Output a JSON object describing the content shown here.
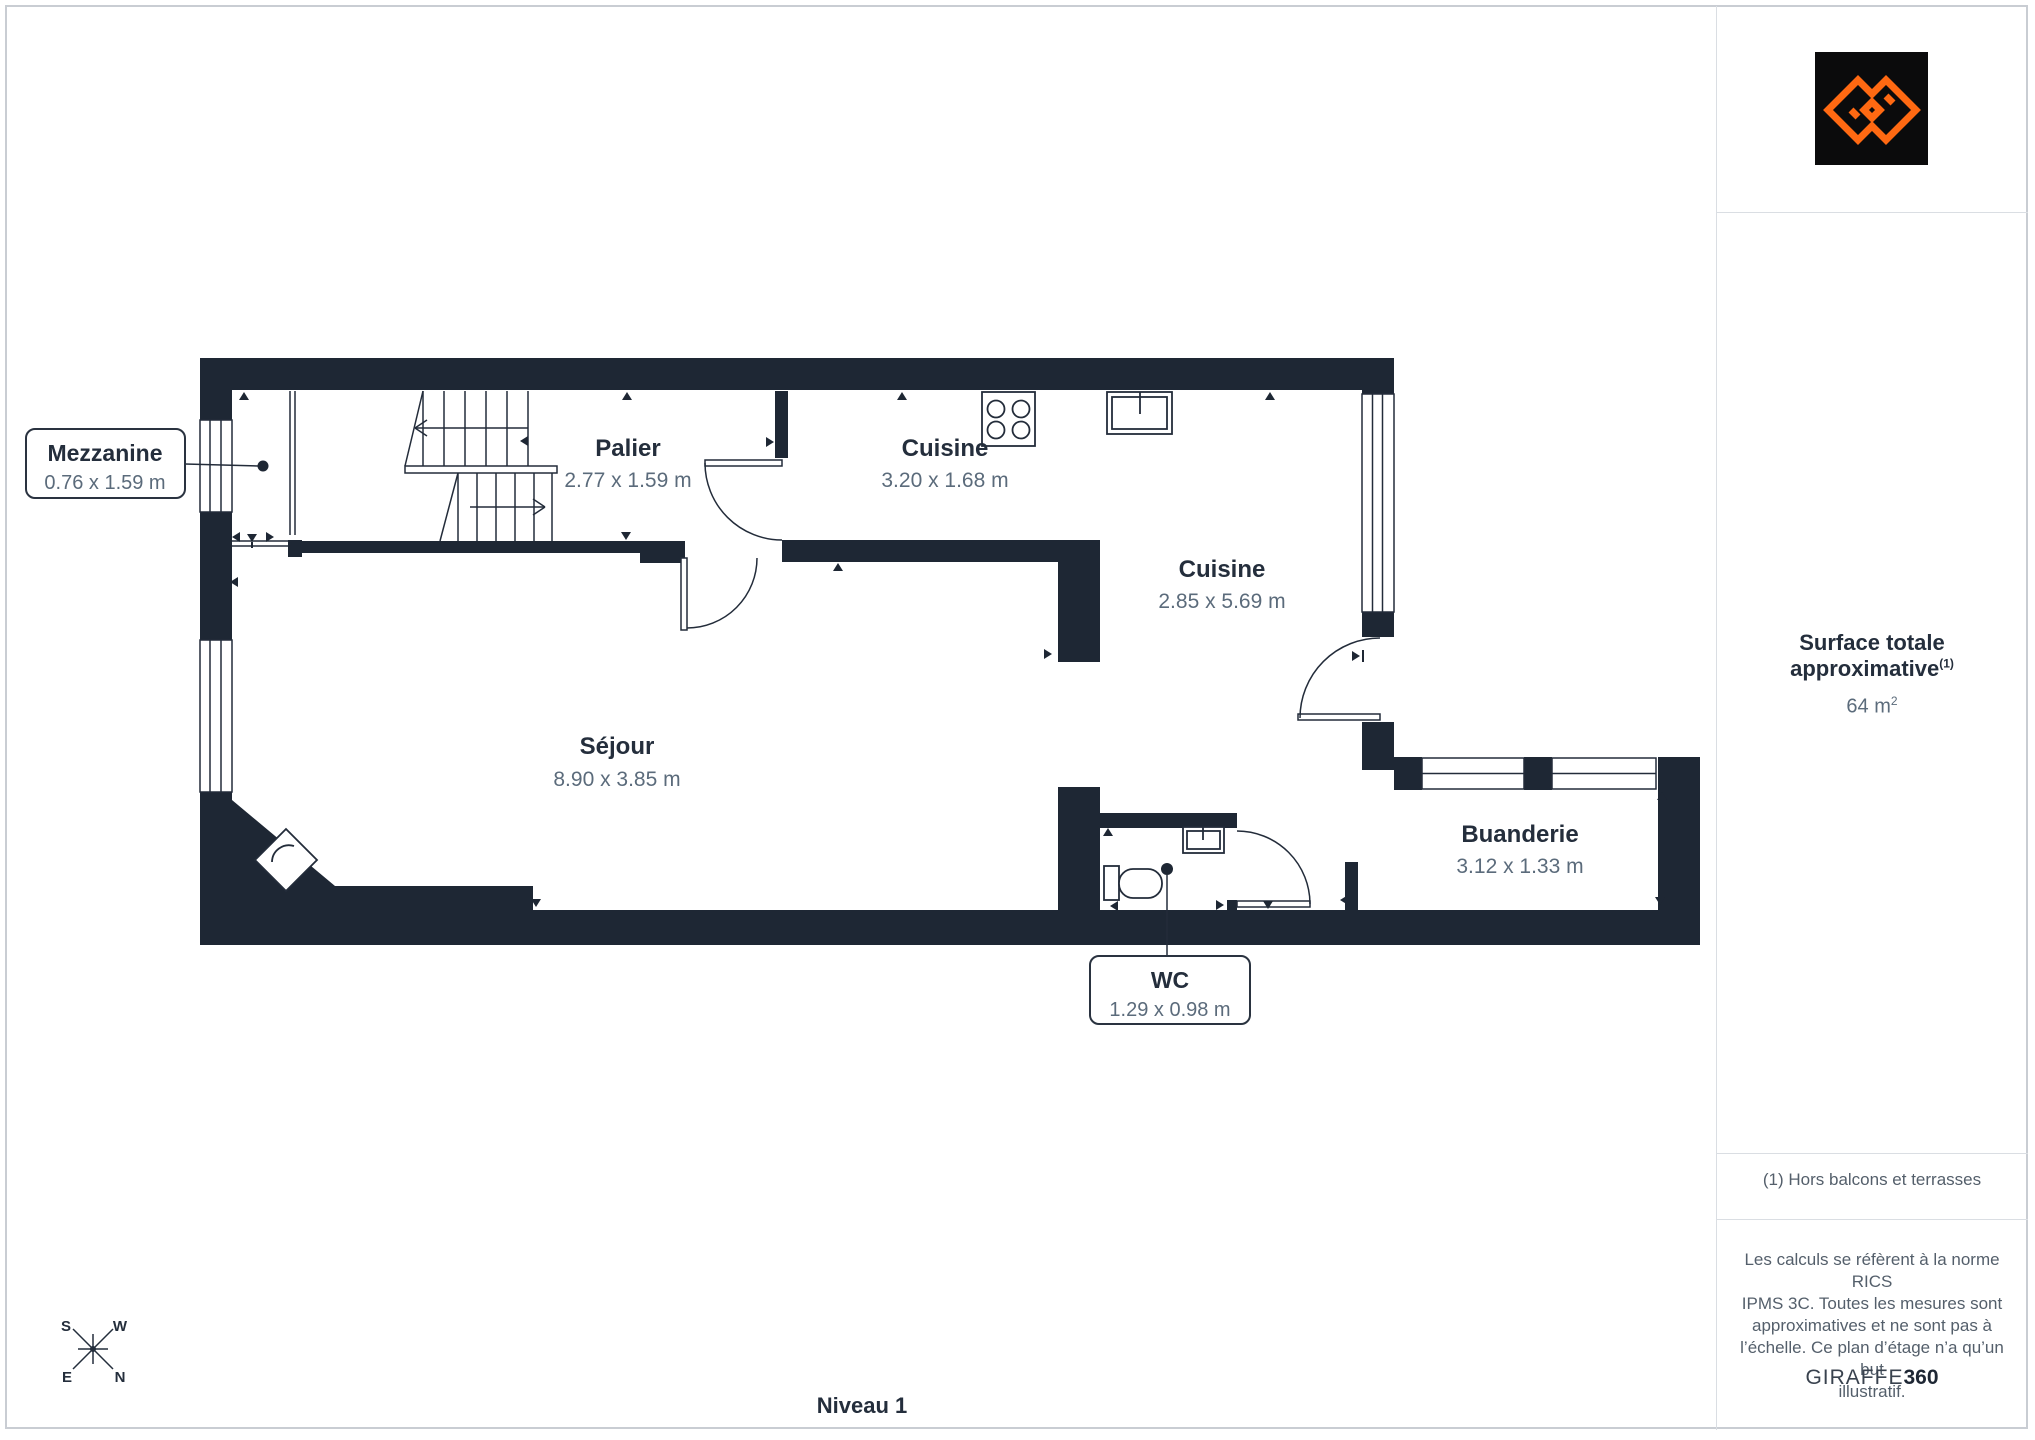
{
  "floor_plan": {
    "level_label": "Niveau 1",
    "rooms": [
      {
        "id": "mezzanine",
        "name": "Mezzanine",
        "dims": "0.76 x 1.59 m",
        "callout": true
      },
      {
        "id": "palier",
        "name": "Palier",
        "dims": "2.77 x 1.59 m"
      },
      {
        "id": "cuisine-haut",
        "name": "Cuisine",
        "dims": "3.20 x 1.68 m"
      },
      {
        "id": "cuisine",
        "name": "Cuisine",
        "dims": "2.85 x 5.69 m"
      },
      {
        "id": "sejour",
        "name": "Séjour",
        "dims": "8.90 x 3.85 m"
      },
      {
        "id": "buanderie",
        "name": "Buanderie",
        "dims": "3.12 x 1.33 m"
      },
      {
        "id": "wc",
        "name": "WC",
        "dims": "1.29 x 0.98 m",
        "callout": true
      }
    ],
    "fixtures": [
      "staircase",
      "stove-4-burner",
      "kitchen-sink",
      "wc-sink",
      "wc-toilet",
      "corner-shower"
    ],
    "compass": {
      "s": "S",
      "w": "W",
      "e": "E",
      "n": "N"
    }
  },
  "sidebar": {
    "logo": "giraffe360-monogram",
    "surface_title": "Surface totale approximative",
    "surface_note_ref": "(1)",
    "surface_value": "64 m",
    "surface_value_sup": "2",
    "footnote": "(1) Hors balcons et terrasses",
    "disclaimer_lines": [
      "Les calculs se réfèrent à la norme RICS",
      "IPMS 3C. Toutes les mesures sont",
      "approximatives et ne sont pas à",
      "l’échelle. Ce plan d’étage n’a qu’un but",
      "illustratif."
    ],
    "brand_name": "GIRAFFE",
    "brand_suffix": "360"
  },
  "colors": {
    "wall": "#1E2734",
    "label_text": "#242E3C",
    "dim_text": "#5B6B7B",
    "logo_orange": "#FF6912",
    "logo_bg": "#0B0B0C",
    "divider": "#DADEE3"
  }
}
